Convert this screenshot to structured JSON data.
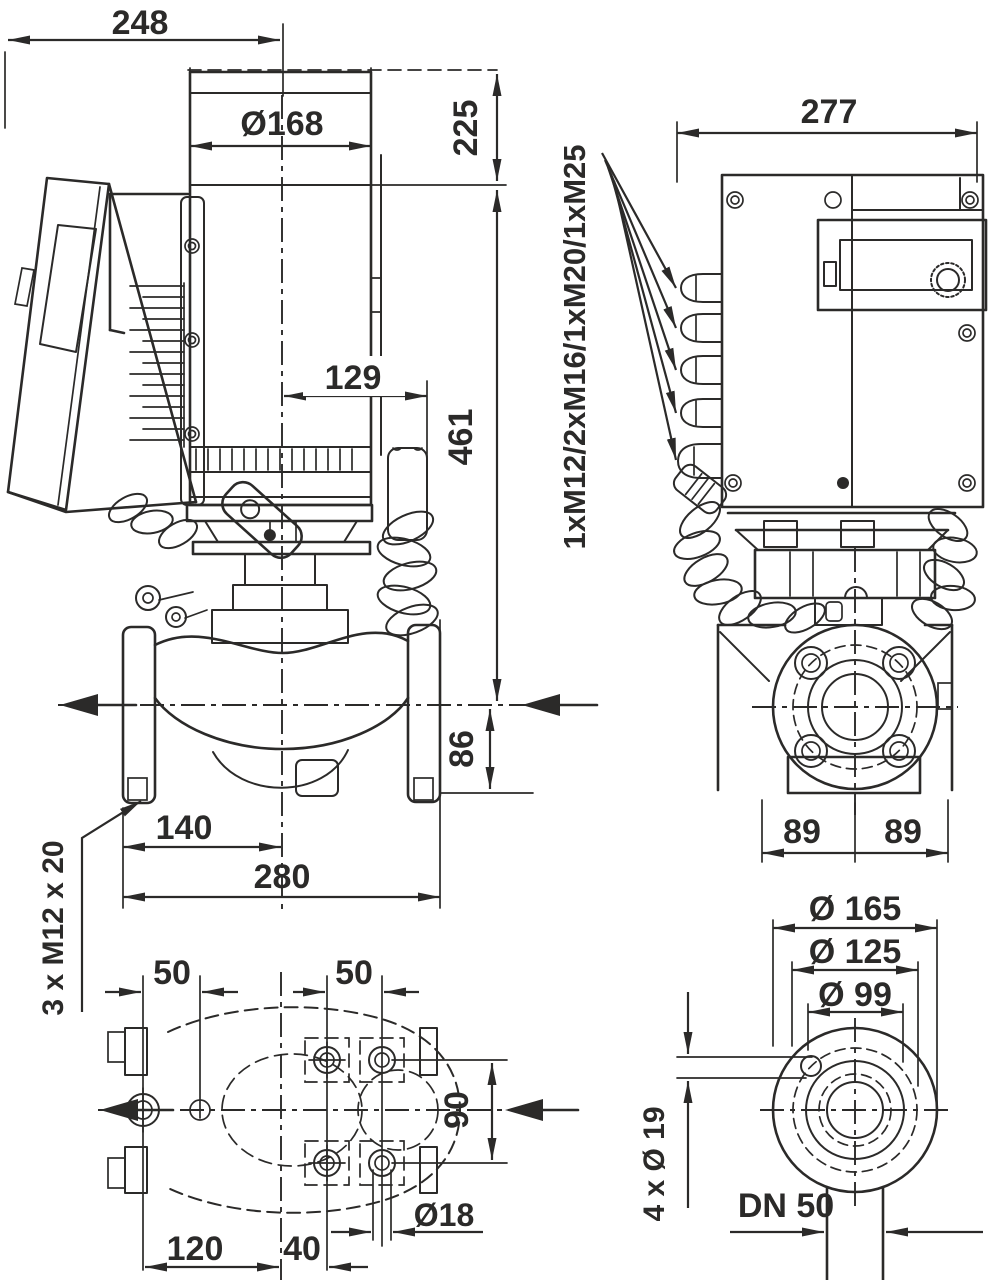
{
  "drawing": {
    "kind": "pump-dimensional-drawing",
    "colors": {
      "ink": "#2b2a29",
      "background": "#ffffff",
      "highlight_box": "#ffffff"
    },
    "views": {
      "side": "side-view",
      "front": "front-view",
      "plan": "mounting-plan-view",
      "flange": "flange-view"
    }
  },
  "dims": {
    "d248": "248",
    "d168": "Ø168",
    "d225": "225",
    "d461": "461",
    "d129": "129",
    "d86": "86",
    "d140": "140",
    "d280": "280",
    "foot_thread": "3 x M12 x 20",
    "d277": "277",
    "glands": "1xM12/2xM16/1xM20/1xM25",
    "d89l": "89",
    "d89r": "89",
    "p50l": "50",
    "p50r": "50",
    "p90": "90",
    "p18": "Ø18",
    "p120": "120",
    "p40": "40",
    "f165": "Ø 165",
    "f125": "Ø 125",
    "f99": "Ø 99",
    "f19": "4 x Ø 19",
    "fdn": "DN 50"
  }
}
